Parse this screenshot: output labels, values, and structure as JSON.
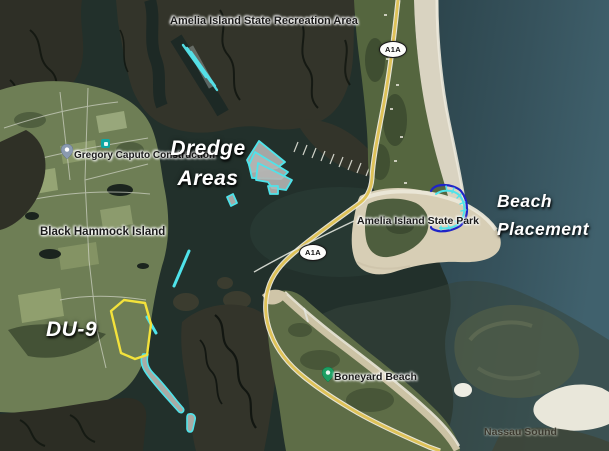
{
  "title": "Amelia Island dredge areas and beach placement satellite map",
  "labels": {
    "recreation_area": "Amelia Island State Recreation Area",
    "dredge_areas": [
      "Dredge",
      "Areas"
    ],
    "beach_placement": [
      "Beach",
      "Placement"
    ],
    "du9": "DU-9",
    "black_hammock_island": "Black Hammock Island",
    "gregory_caputo": "Gregory Caputo Construction",
    "state_park": "Amelia Island State Park",
    "boneyard_beach": "Boneyard Beach",
    "nassau_sound": "Nassau Sound"
  },
  "route_shields": [
    {
      "label": "A1A"
    },
    {
      "label": "A1A"
    }
  ],
  "icons": {
    "construction_pin": "map-pin-icon",
    "boneyard_pin": "map-pin-icon",
    "poi": "storefront-icon"
  },
  "colors": {
    "annotation_cyan": "#52E5EC",
    "annotation_navy": "#1F24C8",
    "du9_yellow": "#F3E23B",
    "road_yellow": "#DEC258",
    "label_white": "#FFFFFF",
    "label_dark": "#1B1B1B",
    "pin_green": "#1D9F63",
    "pin_gray": "#8A9AB0",
    "poi_teal": "#0FA6A2",
    "water_dark": "#22302B",
    "ocean_blue": "#3E5F6B",
    "marsh": "#33342A",
    "land_green": "#6E7E55",
    "sand": "#D9D3C1"
  }
}
